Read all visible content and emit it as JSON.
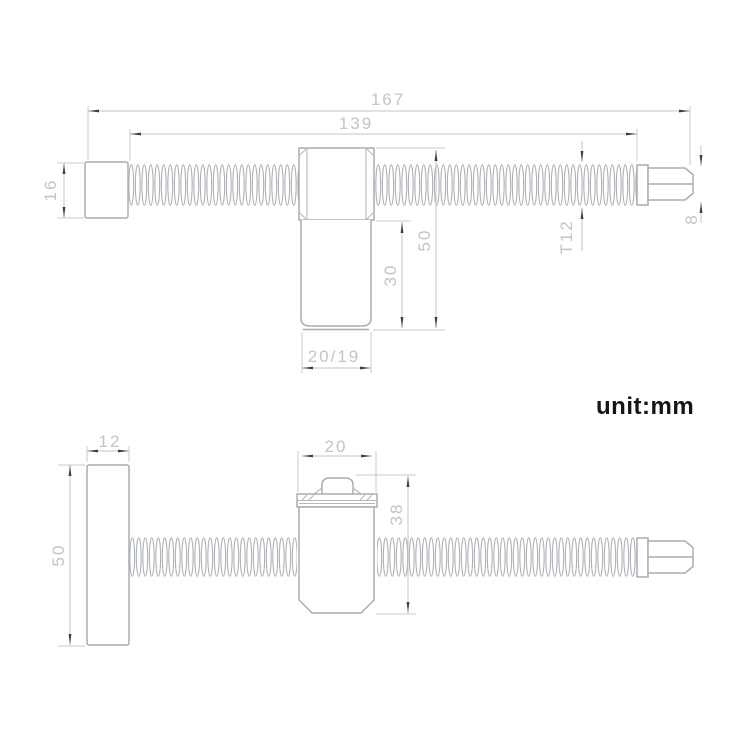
{
  "unit_label": "unit:mm",
  "upper_view": {
    "overall_length": "167",
    "thread_length": "139",
    "head_height": "16",
    "block_height_total": "50",
    "boss_length": "30",
    "boss_diameter": "20/19",
    "thread_spec": "T12",
    "tip_width": "8"
  },
  "lower_view": {
    "plate_thickness": "12",
    "plate_height": "50",
    "block_width": "20",
    "block_height": "38"
  }
}
